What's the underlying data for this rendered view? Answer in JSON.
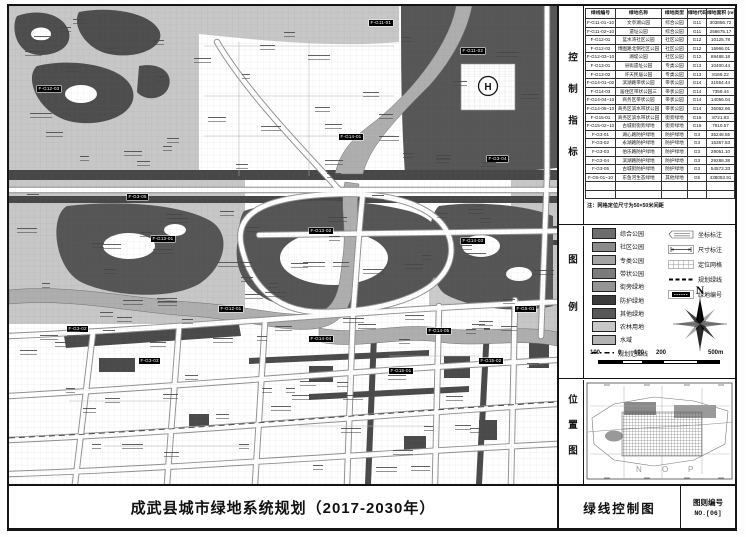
{
  "title_block": {
    "project_title": "成武县城市绿地系统规划（2017-2030年）",
    "sheet_name": "绿线控制图",
    "sheet_no_label": "图则编号",
    "sheet_no": "NO.[06]"
  },
  "sections": {
    "control": "控制指标",
    "legend": "图例",
    "location": "位置图"
  },
  "control_table": {
    "headers": [
      "绿线编号",
      "绿地名称",
      "绿地类型",
      "绿地代码",
      "绿地面积 (m²)"
    ],
    "rows": [
      {
        "code": "F-G11-01~10",
        "name": "文亭湖公园",
        "type": "综合公园",
        "cls": "G11",
        "area": "303856.72"
      },
      {
        "code": "F-G11-02~10",
        "name": "遗址公园",
        "type": "综合公园",
        "cls": "G11",
        "area": "256675.17"
      },
      {
        "code": "F-G12-01",
        "name": "蓝水湾社区公园",
        "type": "社区公园",
        "cls": "G12",
        "area": "10125.78"
      },
      {
        "code": "F-G12-02",
        "name": "博囿路北侧社区公园",
        "type": "社区公园",
        "cls": "G12",
        "area": "15966.01"
      },
      {
        "code": "F-G12-03~10",
        "name": "湖堤公园",
        "type": "社区公园",
        "cls": "G12",
        "area": "89488.18"
      },
      {
        "code": "F-G13-01",
        "name": "县衙遗址公园",
        "type": "专类公园",
        "cls": "G13",
        "area": "10400.44"
      },
      {
        "code": "F-G13-02",
        "name": "许天民居公园",
        "type": "专类公园",
        "cls": "G13",
        "area": "8169.22"
      },
      {
        "code": "F-G14-01~02",
        "name": "滨湖路带状公园",
        "type": "带状公园",
        "cls": "G14",
        "area": "31554.44"
      },
      {
        "code": "F-G14-03",
        "name": "居住区带状公园三",
        "type": "带状公园",
        "cls": "G14",
        "area": "7359.44"
      },
      {
        "code": "F-G14-04~10",
        "name": "商务区带状公园",
        "type": "带状公园",
        "cls": "G14",
        "area": "14056.04"
      },
      {
        "code": "F-G14-05~10",
        "name": "商务区滨水带状公园",
        "type": "带状公园",
        "cls": "G14",
        "area": "35062.66"
      },
      {
        "code": "F-G15-01",
        "name": "商务区滨水带状公园",
        "type": "街旁绿地",
        "cls": "G15",
        "area": "8721.93"
      },
      {
        "code": "F-G15-02~10",
        "name": "古城街街旁绿地",
        "type": "街旁绿地",
        "cls": "G15",
        "area": "7910.57"
      },
      {
        "code": "F-G3-01",
        "name": "湖心路防护绿地",
        "type": "防护绿地",
        "cls": "G3",
        "area": "35248.55"
      },
      {
        "code": "F-G3-02",
        "name": "永湖路防护绿地",
        "type": "防护绿地",
        "cls": "G3",
        "area": "15367.53"
      },
      {
        "code": "F-G3-03",
        "name": "伯乐路防护绿地",
        "type": "防护绿地",
        "cls": "G3",
        "area": "29051.10"
      },
      {
        "code": "F-G3-04",
        "name": "滨湖路防护绿地",
        "type": "防护绿地",
        "cls": "G3",
        "area": "29288.38"
      },
      {
        "code": "F-G3-05",
        "name": "古城街防护绿地",
        "type": "防护绿地",
        "cls": "G3",
        "area": "54573.33"
      },
      {
        "code": "F-G5-01~10",
        "name": "东鱼河生态绿地",
        "type": "其他绿地",
        "cls": "G5",
        "area": "438053.91"
      }
    ],
    "note": "注：网格定位尺寸为50×50米间距"
  },
  "legend": {
    "area_items": [
      {
        "label": "综合公园",
        "color": "#6d6d6d"
      },
      {
        "label": "社区公园",
        "color": "#8b8b8b"
      },
      {
        "label": "专类公园",
        "color": "#a3a3a3"
      },
      {
        "label": "带状公园",
        "color": "#7b7b7b"
      },
      {
        "label": "街旁绿地",
        "color": "#949494"
      },
      {
        "label": "防护绿地",
        "color": "#3b3b3b"
      },
      {
        "label": "其他绿地",
        "color": "#575757"
      },
      {
        "label": "农林用地",
        "color": "#c7c7c7"
      },
      {
        "label": "水域",
        "color": "#b3b3b3"
      },
      {
        "label": "规划范围线",
        "color": "",
        "line": true
      }
    ],
    "symbol_items": [
      {
        "label": "坐标标注"
      },
      {
        "label": "尺寸标注"
      },
      {
        "label": "定位网格"
      },
      {
        "label": "规划绿线"
      },
      {
        "label": "绿地编号"
      }
    ],
    "compass_label": "N",
    "scale_labels": [
      "100",
      "0",
      "100",
      "200",
      "500m"
    ]
  },
  "location_map": {
    "grid_letters": [
      "N",
      "O",
      "P"
    ]
  },
  "map": {
    "h_symbol": "H",
    "labels": [
      {
        "code": "F-G11-01",
        "x": 360,
        "y": 14
      },
      {
        "code": "F-G11-02",
        "x": 452,
        "y": 42
      },
      {
        "code": "F-G12-03",
        "x": 28,
        "y": 80
      },
      {
        "code": "F-G3-05",
        "x": 118,
        "y": 188
      },
      {
        "code": "F-G13-01",
        "x": 142,
        "y": 230
      },
      {
        "code": "F-G14-01",
        "x": 330,
        "y": 128
      },
      {
        "code": "F-G3-04",
        "x": 478,
        "y": 150
      },
      {
        "code": "F-G13-02",
        "x": 300,
        "y": 222
      },
      {
        "code": "F-G14-03",
        "x": 452,
        "y": 232
      },
      {
        "code": "F-G12-01",
        "x": 210,
        "y": 300
      },
      {
        "code": "F-G3-02",
        "x": 58,
        "y": 320
      },
      {
        "code": "F-G14-04",
        "x": 300,
        "y": 330
      },
      {
        "code": "F-G14-05",
        "x": 418,
        "y": 322
      },
      {
        "code": "F-G15-01",
        "x": 380,
        "y": 362
      },
      {
        "code": "F-G15-02",
        "x": 470,
        "y": 352
      },
      {
        "code": "F-G3-03",
        "x": 130,
        "y": 352
      },
      {
        "code": "F-G5-01",
        "x": 506,
        "y": 300
      }
    ]
  }
}
